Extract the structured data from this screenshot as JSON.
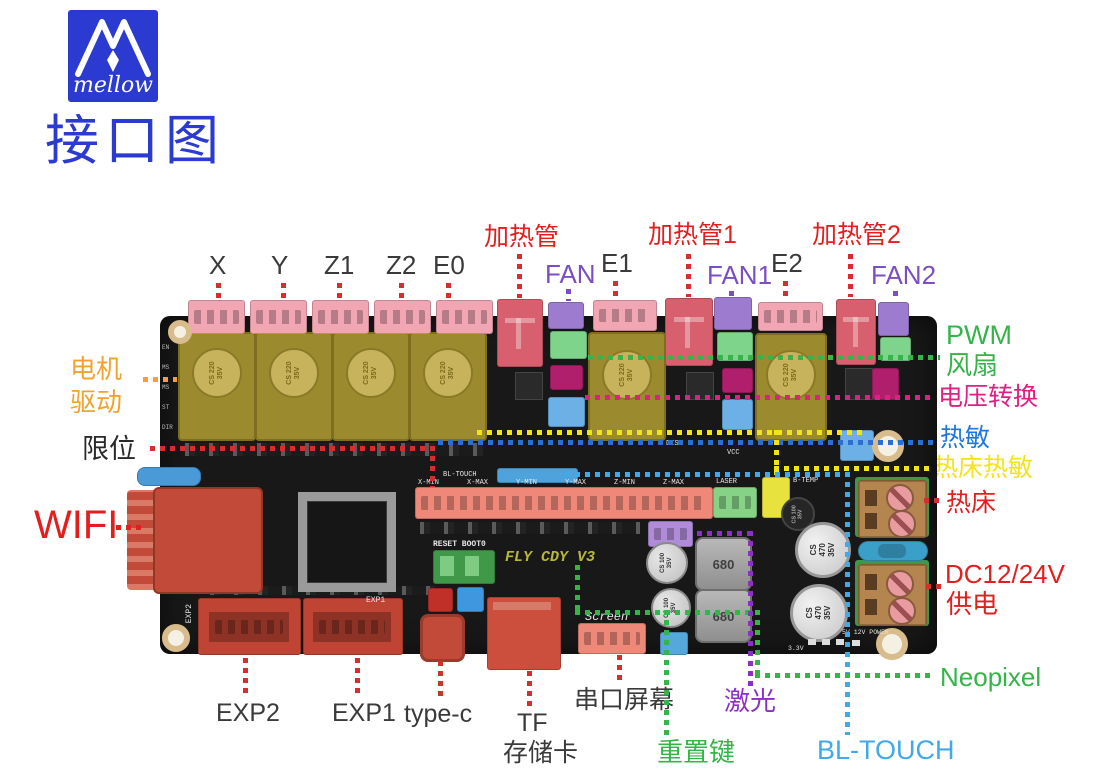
{
  "header": {
    "brand": "mellow",
    "title": "接口图"
  },
  "palette": {
    "title_blue": "#2b3ad0",
    "label_red": "#e31e1e",
    "label_dark": "#3a3a3a",
    "label_purple": "#7b4fc3",
    "label_violet": "#8c2fc4",
    "label_green": "#35b44a",
    "label_magenta": "#e01f85",
    "label_blue": "#2176dd",
    "label_yellow": "#f2e418",
    "label_lightblue": "#42a9e8",
    "label_orange": "#f2a231",
    "pcb_black": "#181818",
    "connector_pink": "#f2a6b4",
    "connector_red": "#d8606e",
    "connector_purple": "#9d7bce",
    "connector_green": "#7fd48c",
    "connector_magenta": "#b01f6c",
    "connector_blue": "#6cb0e6",
    "connector_salmon": "#ef8878",
    "connector_yellow": "#e8e23e",
    "driver_gold": "#9c8a2f",
    "highlight_red": "#c24a38",
    "terminal_brown": "#b5854f"
  },
  "labels": {
    "x": "X",
    "y": "Y",
    "z1": "Z1",
    "z2": "Z2",
    "e0": "E0",
    "heater": "加热管",
    "fan": "FAN",
    "e1": "E1",
    "heater1": "加热管1",
    "fan1": "FAN1",
    "e2": "E2",
    "heater2": "加热管2",
    "fan2": "FAN2",
    "pwm_fan_line1": "PWM",
    "pwm_fan_line2": "风扇",
    "voltage_conv": "电压转换",
    "thermistor": "热敏",
    "bed_thermistor": "热床热敏",
    "bed": "热床",
    "dc_line1": "DC12/24V",
    "dc_line2": "供电",
    "neopixel": "Neopixel",
    "bltouch": "BL-TOUCH",
    "exp2": "EXP2",
    "exp1": "EXP1",
    "typec": "type-c",
    "tf_line1": "TF",
    "tf_line2": "存储卡",
    "serial_screen": "串口屏幕",
    "laser": "激光",
    "reset_key": "重置键",
    "motor_line1": "电机",
    "motor_line2": "驱动",
    "endstop": "限位",
    "wifi": "WIFI"
  },
  "silk": {
    "reset_boot": "RESET BOOT0",
    "model": "FLY CDY V3",
    "exp1": "EXP1",
    "exp2": "EXP2",
    "screen": "Screen",
    "bltouch": "BL-TOUCH",
    "laser": "LASER",
    "btemp": "B-TEMP",
    "dis": "DIS",
    "vcc": "VCC",
    "power": "5V 12V POWER",
    "v33": "3.3V",
    "cap220": "CS 220 35V",
    "cap470": "CS 470 35V",
    "cap100": "CS 100 35V",
    "inductor": "680",
    "endstops": [
      "X-MIN",
      "X-MAX",
      "Y-MIN",
      "Y-MAX",
      "Z-MIN",
      "Z-MAX"
    ],
    "pins": [
      "EN",
      "MS",
      "MS",
      "ST",
      "DIR"
    ]
  }
}
